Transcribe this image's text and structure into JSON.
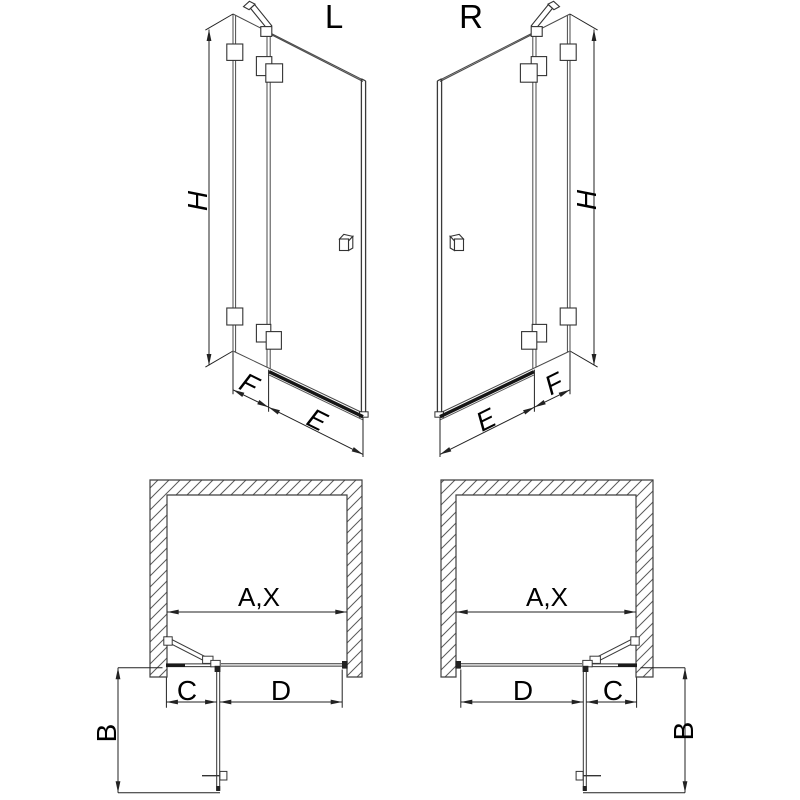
{
  "diagram": {
    "type": "shower-door-technical-drawing",
    "elevation_left": {
      "label": "L",
      "height": "H",
      "fixed_width": "F",
      "door_width": "E"
    },
    "elevation_right": {
      "label": "R",
      "height": "H",
      "fixed_width": "F",
      "door_width": "E"
    },
    "plan_left": {
      "opening": "A,X",
      "depth": "B",
      "fixed": "C",
      "door": "D"
    },
    "plan_right": {
      "opening": "A,X",
      "depth": "B",
      "fixed": "C",
      "door": "D"
    },
    "colors": {
      "glass_line": "#4a4a4a",
      "profile": "#333333",
      "rail": "#161616",
      "dimension": "#222222",
      "hatch": "#5a5a5a",
      "text": "#000000",
      "background": "#ffffff"
    }
  }
}
